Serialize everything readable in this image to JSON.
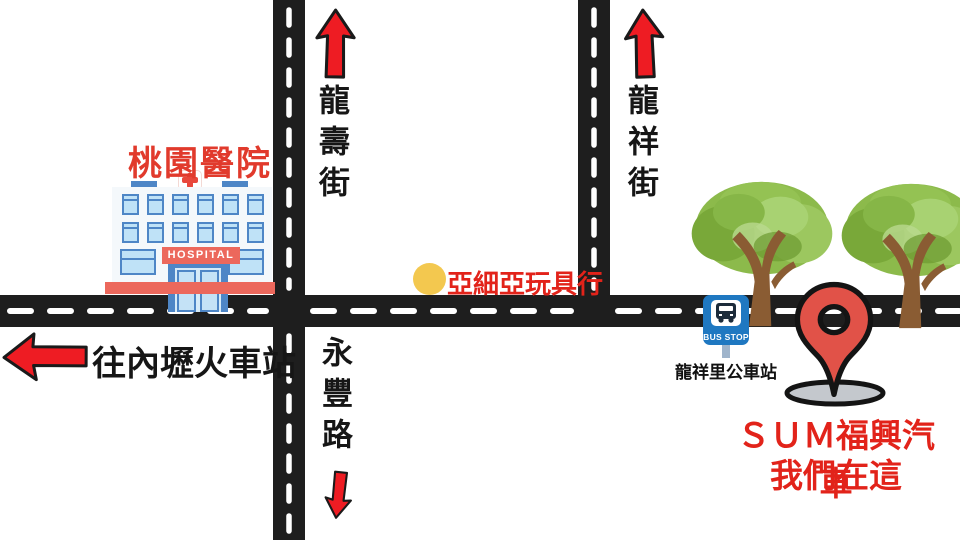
{
  "map": {
    "hospital": {
      "name": "桃園醫院",
      "sign": "HOSPITAL"
    },
    "streets": {
      "north_left": "龍壽街",
      "north_right": "龍祥街",
      "south": "永豐路"
    },
    "direction_west": "往內壢火車站",
    "toy_store": "亞細亞玩具行",
    "bus_stop": {
      "sign": "BUS STOP",
      "name": "龍祥里公車站"
    },
    "destination": {
      "line1": "ＳＵＭ福興汽車",
      "line2": "我們在這"
    },
    "colors": {
      "road": "#1E1E1E",
      "arrow_red": "#EE1C23",
      "pin_red": "#E15248",
      "text_red": "#E2231A",
      "hospital_label_red": "#E13A2C",
      "hospital_salmon": "#EC685C",
      "window_blue": "#4E86C6",
      "bus_blue": "#1F78C1",
      "dot_yellow": "#F3C84F",
      "tree_green": "#8CBA4B",
      "trunk_brown": "#8A5C33",
      "shadow_gray": "#C4C8CD"
    }
  }
}
